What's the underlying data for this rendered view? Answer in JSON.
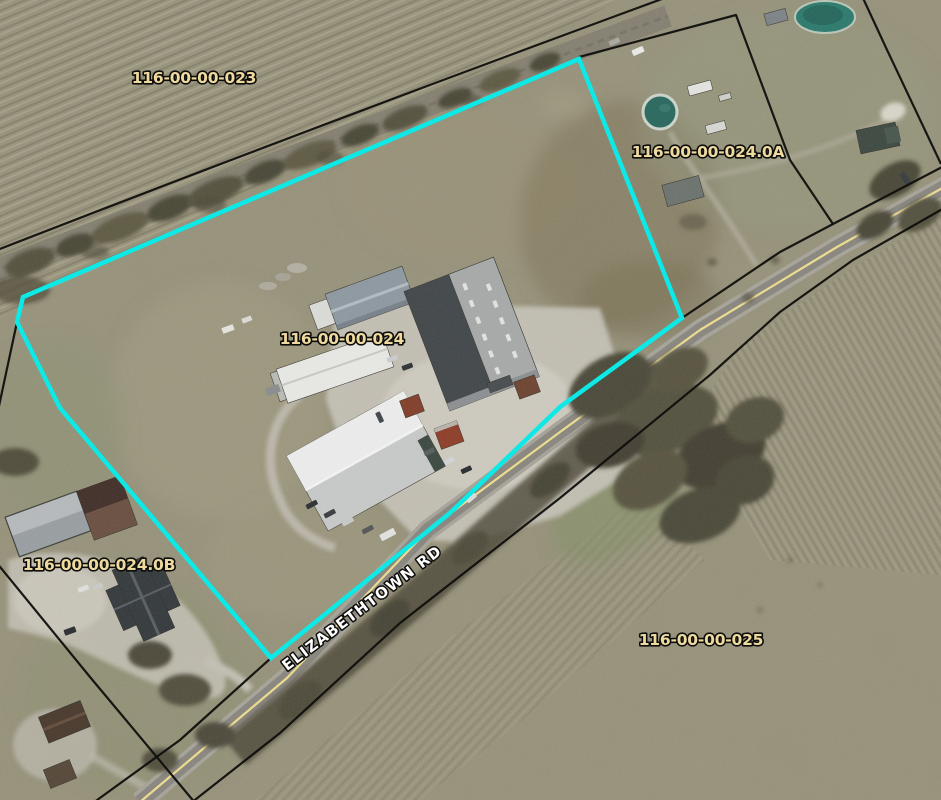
{
  "map": {
    "parcel_labels": [
      {
        "id": "023",
        "text": "116-00-00-023"
      },
      {
        "id": "024.0A",
        "text": "116-00-00-024.0A"
      },
      {
        "id": "024",
        "text": "116-00-00-024"
      },
      {
        "id": "024.0B",
        "text": "116-00-00-024.0B"
      },
      {
        "id": "025",
        "text": "116-00-00-025"
      }
    ],
    "road_label": "ELIZABETHTOWN RD",
    "colors": {
      "selection_outline": "#0ce9e6",
      "parcel_label": "#eeda9f",
      "road_label": "#ffffff",
      "boundary_line": "#0f0f0d",
      "road_centerline": "#eedd8e"
    }
  }
}
